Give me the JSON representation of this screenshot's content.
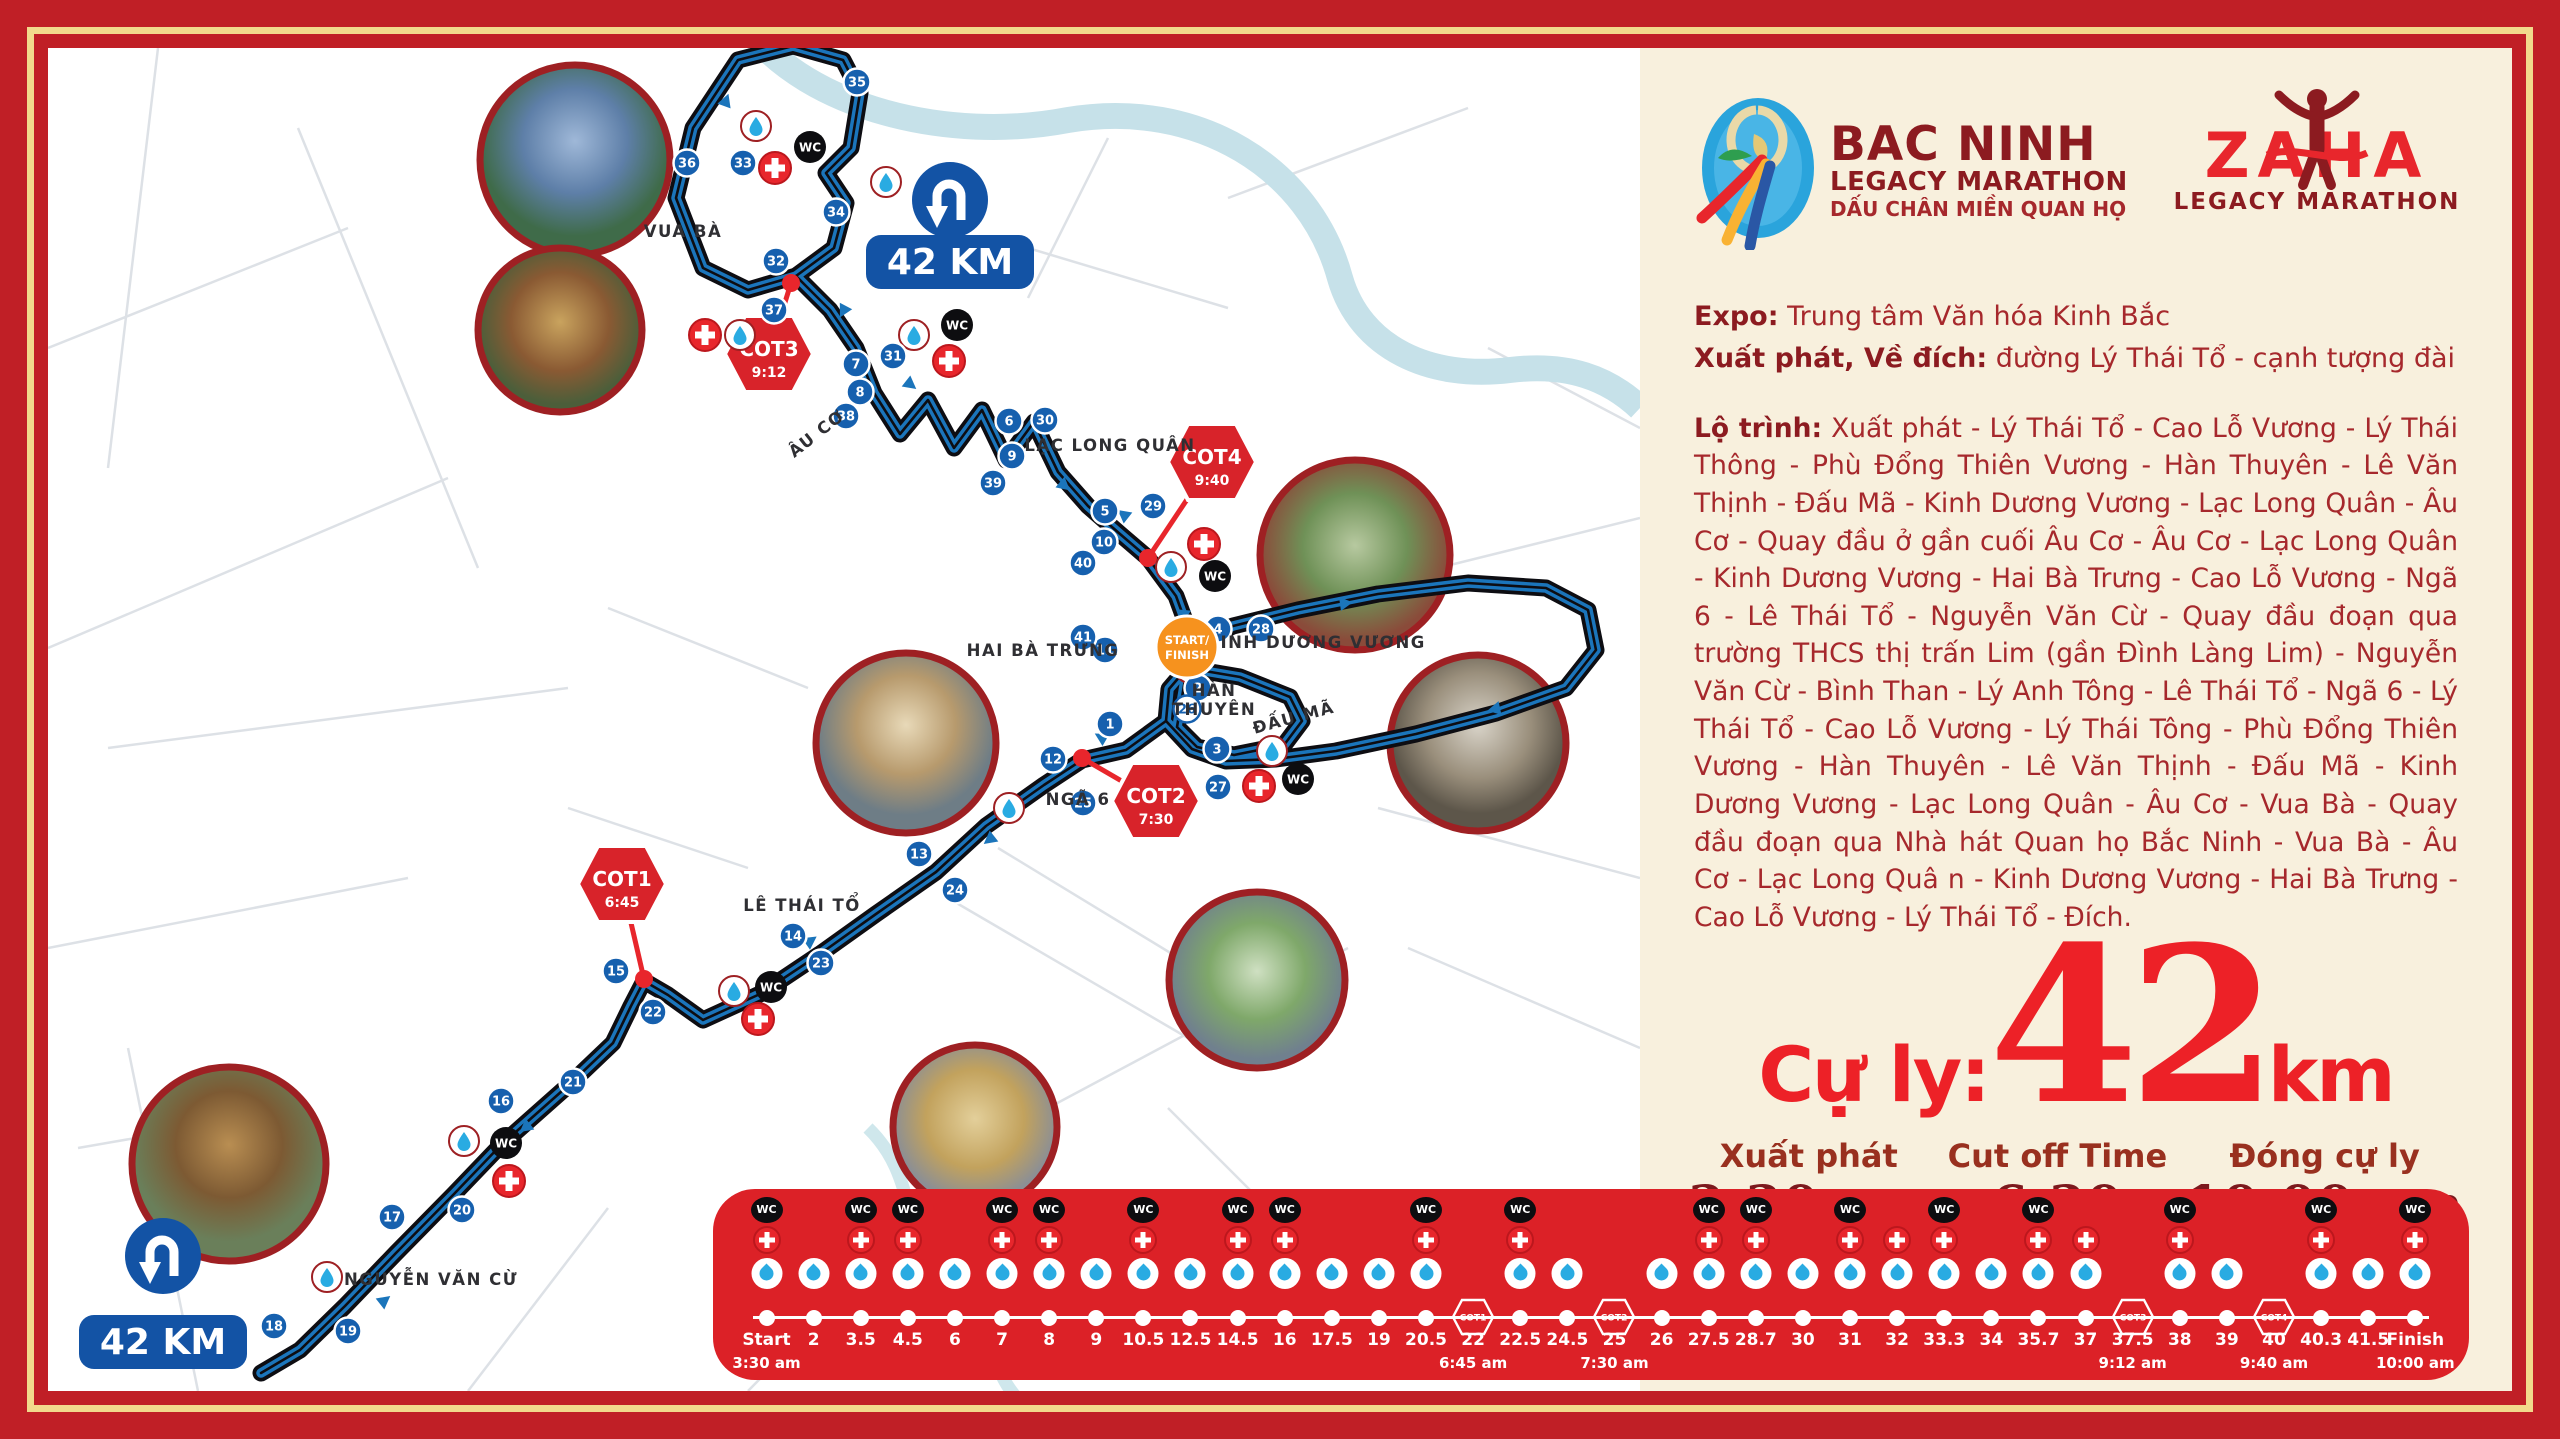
{
  "branding": {
    "bac_ninh_logo": {
      "title": "BAC NINH",
      "subtitle": "LEGACY MARATHON",
      "tagline": "DẤU CHÂN MIỀN QUAN HỌ"
    },
    "zaha_logo": {
      "title": "ZAHA",
      "subtitle": "LEGACY MARATHON"
    }
  },
  "info": {
    "expo_label": "Expo:",
    "expo_value": "Trung tâm Văn hóa Kinh Bắc",
    "start_label": "Xuất phát, Về đích:",
    "start_value": "đường Lý Thái Tổ - cạnh tượng đài"
  },
  "route_description": {
    "label": "Lộ trình:",
    "text": "Xuất phát - Lý Thái Tổ - Cao Lỗ Vương - Lý Thái Thông - Phù Đổng Thiên Vương - Hàn Thuyên - Lê Văn Thịnh - Đấu Mã - Kinh Dương Vương - Lạc Long Quân - Âu Cơ - Quay đầu ở gần cuối Âu Cơ - Âu Cơ - Lạc Long Quân - Kinh Dương Vương - Hai Bà Trưng - Cao Lỗ Vương - Ngã 6 - Lê Thái Tổ - Nguyễn Văn Cừ - Quay đầu đoạn qua trường THCS thị trấn Lim (gần Đình Làng Lim) - Nguyễn Văn Cừ - Bình Than - Lý Anh Tông - Lê Thái Tổ - Ngã 6 - Lý Thái Tổ - Cao Lỗ Vương - Lý Thái Tông - Phù Đổng Thiên Vương - Hàn Thuyên - Lê Văn Thịnh - Đấu Mã - Kinh Dương Vương - Lạc Long Quân - Âu Cơ - Vua Bà - Quay đầu đoạn qua Nhà hát Quan họ Bắc Ninh - Vua Bà - Âu Cơ - Lạc Long Quâ n - Kinh Dương Vương - Hai Bà Trưng - Cao Lỗ Vương - Lý Thái Tổ - Đích."
  },
  "distance": {
    "label": "Cự ly:",
    "value": "42",
    "unit": "km"
  },
  "schedule": [
    {
      "label": "Xuất phát",
      "value": "3:30 am"
    },
    {
      "label": "Cut off Time",
      "value": "6:30"
    },
    {
      "label": "Đóng cự ly",
      "value": "10:00 am"
    }
  ],
  "map": {
    "start_finish": {
      "line1": "START/",
      "line2": "FINISH"
    },
    "km_badges": [
      {
        "label": "42 KM",
        "x": 902,
        "y": 214,
        "icon_x": 902,
        "icon_y": 152
      },
      {
        "label": "42 KM",
        "x": 115,
        "y": 1294,
        "icon_x": 115,
        "icon_y": 1208
      }
    ],
    "street_labels": [
      {
        "text": "VUA BÀ",
        "x": 635,
        "y": 189,
        "rotate": 0
      },
      {
        "text": "ÂU CƠ",
        "x": 772,
        "y": 390,
        "rotate": -38
      },
      {
        "text": "LẠC LONG QUÂN",
        "x": 1062,
        "y": 403,
        "rotate": 0
      },
      {
        "text": "HAI BÀ TRƯNG",
        "x": 995,
        "y": 608,
        "rotate": 0
      },
      {
        "text": "KINH DƯƠNG VƯƠNG",
        "x": 1268,
        "y": 600,
        "rotate": 0
      },
      {
        "text": "HÀN\nTHUYÊN",
        "x": 1166,
        "y": 648,
        "rotate": 0
      },
      {
        "text": "ĐẤU MÃ",
        "x": 1247,
        "y": 675,
        "rotate": -15
      },
      {
        "text": "NGÃ 6",
        "x": 1030,
        "y": 757,
        "rotate": 0
      },
      {
        "text": "LÊ THÁI TỔ",
        "x": 754,
        "y": 863,
        "rotate": 0
      },
      {
        "text": "NGUYỄN VĂN CỪ",
        "x": 383,
        "y": 1237,
        "rotate": 0
      }
    ],
    "waypoints": [
      {
        "n": "1",
        "x": 1062,
        "y": 676
      },
      {
        "n": "2",
        "x": 1150,
        "y": 640
      },
      {
        "n": "3",
        "x": 1169,
        "y": 701
      },
      {
        "n": "4",
        "x": 1170,
        "y": 581
      },
      {
        "n": "5",
        "x": 1057,
        "y": 463
      },
      {
        "n": "6",
        "x": 961,
        "y": 373
      },
      {
        "n": "7",
        "x": 808,
        "y": 316
      },
      {
        "n": "8",
        "x": 812,
        "y": 344
      },
      {
        "n": "9",
        "x": 964,
        "y": 408
      },
      {
        "n": "10",
        "x": 1056,
        "y": 494
      },
      {
        "n": "11",
        "x": 1057,
        "y": 602
      },
      {
        "n": "12",
        "x": 1005,
        "y": 711
      },
      {
        "n": "13",
        "x": 871,
        "y": 806
      },
      {
        "n": "14",
        "x": 745,
        "y": 888
      },
      {
        "n": "15",
        "x": 568,
        "y": 923
      },
      {
        "n": "16",
        "x": 453,
        "y": 1053
      },
      {
        "n": "17",
        "x": 344,
        "y": 1169
      },
      {
        "n": "18",
        "x": 226,
        "y": 1278
      },
      {
        "n": "19",
        "x": 300,
        "y": 1283
      },
      {
        "n": "20",
        "x": 414,
        "y": 1162
      },
      {
        "n": "21",
        "x": 525,
        "y": 1034
      },
      {
        "n": "22",
        "x": 605,
        "y": 964
      },
      {
        "n": "23",
        "x": 773,
        "y": 915
      },
      {
        "n": "24",
        "x": 907,
        "y": 842
      },
      {
        "n": "25",
        "x": 1035,
        "y": 755
      },
      {
        "n": "26",
        "x": 1139,
        "y": 661,
        "variant": "light"
      },
      {
        "n": "27",
        "x": 1170,
        "y": 739
      },
      {
        "n": "28",
        "x": 1213,
        "y": 581
      },
      {
        "n": "29",
        "x": 1105,
        "y": 458
      },
      {
        "n": "30",
        "x": 997,
        "y": 372
      },
      {
        "n": "31",
        "x": 845,
        "y": 308
      },
      {
        "n": "32",
        "x": 728,
        "y": 213
      },
      {
        "n": "33",
        "x": 695,
        "y": 115
      },
      {
        "n": "34",
        "x": 788,
        "y": 164
      },
      {
        "n": "35",
        "x": 809,
        "y": 34
      },
      {
        "n": "36",
        "x": 639,
        "y": 115
      },
      {
        "n": "37",
        "x": 726,
        "y": 262
      },
      {
        "n": "38",
        "x": 798,
        "y": 368
      },
      {
        "n": "39",
        "x": 945,
        "y": 435
      },
      {
        "n": "40",
        "x": 1035,
        "y": 515
      },
      {
        "n": "41",
        "x": 1035,
        "y": 589
      }
    ],
    "amenities": [
      {
        "type": "water",
        "x": 708,
        "y": 78
      },
      {
        "type": "wc",
        "x": 762,
        "y": 99
      },
      {
        "type": "medical",
        "x": 727,
        "y": 120
      },
      {
        "type": "water",
        "x": 838,
        "y": 134
      },
      {
        "type": "wc",
        "x": 909,
        "y": 277
      },
      {
        "type": "medical",
        "x": 901,
        "y": 313
      },
      {
        "type": "water",
        "x": 866,
        "y": 287
      },
      {
        "type": "medical",
        "x": 657,
        "y": 287
      },
      {
        "type": "water",
        "x": 692,
        "y": 287
      },
      {
        "type": "medical",
        "x": 1156,
        "y": 496
      },
      {
        "type": "wc",
        "x": 1167,
        "y": 528
      },
      {
        "type": "water",
        "x": 1123,
        "y": 519
      },
      {
        "type": "water",
        "x": 1142,
        "y": 620
      },
      {
        "type": "medical",
        "x": 1211,
        "y": 738
      },
      {
        "type": "wc",
        "x": 1250,
        "y": 731
      },
      {
        "type": "water",
        "x": 1224,
        "y": 703
      },
      {
        "type": "water",
        "x": 961,
        "y": 760
      },
      {
        "type": "wc",
        "x": 723,
        "y": 939
      },
      {
        "type": "water",
        "x": 686,
        "y": 943
      },
      {
        "type": "medical",
        "x": 710,
        "y": 971
      },
      {
        "type": "wc",
        "x": 458,
        "y": 1095
      },
      {
        "type": "water",
        "x": 416,
        "y": 1093
      },
      {
        "type": "medical",
        "x": 461,
        "y": 1133
      },
      {
        "type": "water",
        "x": 279,
        "y": 1229
      }
    ],
    "cot_signs": [
      {
        "name": "COT1",
        "time": "6:45",
        "x": 574,
        "y": 836,
        "dot_x": 596,
        "dot_y": 931
      },
      {
        "name": "COT2",
        "time": "7:30",
        "x": 1108,
        "y": 753,
        "dot_x": 1034,
        "dot_y": 710
      },
      {
        "name": "COT3",
        "time": "9:12",
        "x": 721,
        "y": 306,
        "dot_x": 743,
        "dot_y": 235
      },
      {
        "name": "COT4",
        "time": "9:40",
        "x": 1164,
        "y": 414,
        "dot_x": 1100,
        "dot_y": 510
      }
    ],
    "photos": [
      {
        "name": "photo-stadium",
        "x": 527,
        "y": 112,
        "r": 95
      },
      {
        "name": "photo-temple-gate",
        "x": 512,
        "y": 282,
        "r": 82
      },
      {
        "name": "photo-clock-tower",
        "x": 858,
        "y": 695,
        "r": 90
      },
      {
        "name": "photo-boulevard",
        "x": 1307,
        "y": 507,
        "r": 95
      },
      {
        "name": "photo-statue",
        "x": 1430,
        "y": 695,
        "r": 88
      },
      {
        "name": "photo-roundabout",
        "x": 1209,
        "y": 932,
        "r": 88
      },
      {
        "name": "photo-water-temple",
        "x": 181,
        "y": 1116,
        "r": 97
      },
      {
        "name": "photo-monument",
        "x": 927,
        "y": 1079,
        "r": 82
      }
    ]
  },
  "timeline": {
    "stations": [
      {
        "km": "Start",
        "time": "3:30 am",
        "wc": true,
        "cross": true,
        "water": true
      },
      {
        "km": "2",
        "water": true
      },
      {
        "km": "3.5",
        "wc": true,
        "cross": true,
        "water": true
      },
      {
        "km": "4.5",
        "wc": true,
        "cross": true,
        "water": true
      },
      {
        "km": "6",
        "water": true
      },
      {
        "km": "7",
        "wc": true,
        "cross": true,
        "water": true
      },
      {
        "km": "8",
        "wc": true,
        "cross": true,
        "water": true
      },
      {
        "km": "9",
        "water": true
      },
      {
        "km": "10.5",
        "wc": true,
        "cross": true,
        "water": true
      },
      {
        "km": "12.5",
        "water": true
      },
      {
        "km": "14.5",
        "wc": true,
        "cross": true,
        "water": true
      },
      {
        "km": "16",
        "wc": true,
        "cross": true,
        "water": true
      },
      {
        "km": "17.5",
        "water": true
      },
      {
        "km": "19",
        "water": true
      },
      {
        "km": "20.5",
        "wc": true,
        "cross": true,
        "water": true
      },
      {
        "km": "22",
        "cot": "COT1",
        "time": "6:45 am"
      },
      {
        "km": "22.5",
        "wc": true,
        "cross": true,
        "water": true
      },
      {
        "km": "24.5",
        "water": true
      },
      {
        "km": "25",
        "cot": "COT2",
        "time": "7:30 am"
      },
      {
        "km": "26",
        "water": true
      },
      {
        "km": "27.5",
        "wc": true,
        "cross": true,
        "water": true
      },
      {
        "km": "28.7",
        "wc": true,
        "cross": true,
        "water": true
      },
      {
        "km": "30",
        "water": true
      },
      {
        "km": "31",
        "wc": true,
        "cross": true,
        "water": true
      },
      {
        "km": "32",
        "cross": true,
        "water": true
      },
      {
        "km": "33.3",
        "wc": true,
        "cross": true,
        "water": true
      },
      {
        "km": "34",
        "water": true
      },
      {
        "km": "35.7",
        "wc": true,
        "cross": true,
        "water": true
      },
      {
        "km": "37",
        "cross": true,
        "water": true
      },
      {
        "km": "37.5",
        "cot": "COT3",
        "time": "9:12 am"
      },
      {
        "km": "38",
        "wc": true,
        "cross": true,
        "water": true
      },
      {
        "km": "39",
        "water": true
      },
      {
        "km": "40",
        "cot": "COT4",
        "time": "9:40 am"
      },
      {
        "km": "40.3",
        "wc": true,
        "cross": true,
        "water": true
      },
      {
        "km": "41.5",
        "water": true
      },
      {
        "km": "Finish",
        "wc": true,
        "cross": true,
        "water": true,
        "time": "10:00 am"
      }
    ]
  },
  "colors": {
    "frame_red": "#c01f26",
    "gold": "#f2d98c",
    "panel_cream": "#f8f0dd",
    "dark_maroon": "#8c1b20",
    "body_red": "#a6282c",
    "bright_red": "#ed2127",
    "bar_red": "#dc2127",
    "route_blue": "#1b75bb",
    "route_casing": "#0d0d12",
    "waypoint_blue": "#1660ae",
    "uturn_blue": "#1353a5",
    "cot_red": "#d8232a",
    "start_finish_orange": "#f6921e",
    "water_drop_blue": "#29abe2",
    "street_gray": "#d9dee3",
    "river_blue": "#c6e1e9"
  }
}
